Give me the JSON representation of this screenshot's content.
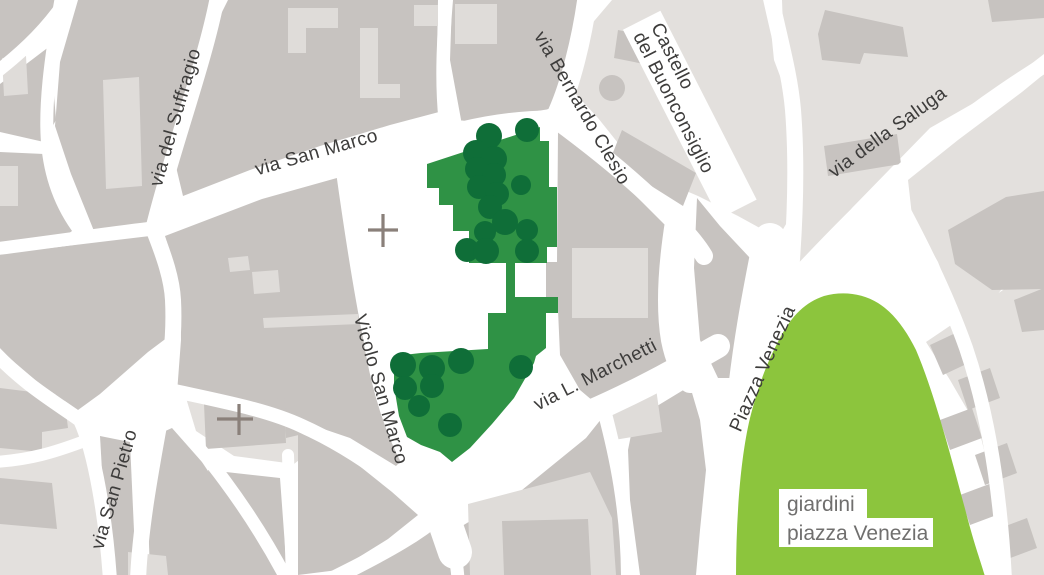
{
  "colors": {
    "street_white": "#ffffff",
    "block_gray": "#c7c3c0",
    "building_light": "#dfdcd9",
    "base_light": "#e3e0dd",
    "park_green": "#2f9245",
    "tree_green": "#0f6e38",
    "lawn_green": "#8cc53d",
    "label_dark": "#3d3c3b",
    "label_gray": "#706f6e",
    "cross_gray": "#8a807a",
    "label_bg": "#ffffff"
  },
  "street_labels": {
    "suffragio": "via del Suffragio",
    "san_marco": "via San Marco",
    "clesio": "via Bernardo Clesio",
    "saluga": "via della Saluga",
    "vicolo": "Vicolo San Marco",
    "marchetti": "via L. Marchetti",
    "san_pietro": "via San Pietro",
    "piazza_venezia": "Piazza Venezia"
  },
  "place_labels": {
    "castello_line1": "Castello",
    "castello_line2": "del Buonconsiglio",
    "giardini_line1": "giardini",
    "giardini_line2": "piazza Venezia"
  }
}
